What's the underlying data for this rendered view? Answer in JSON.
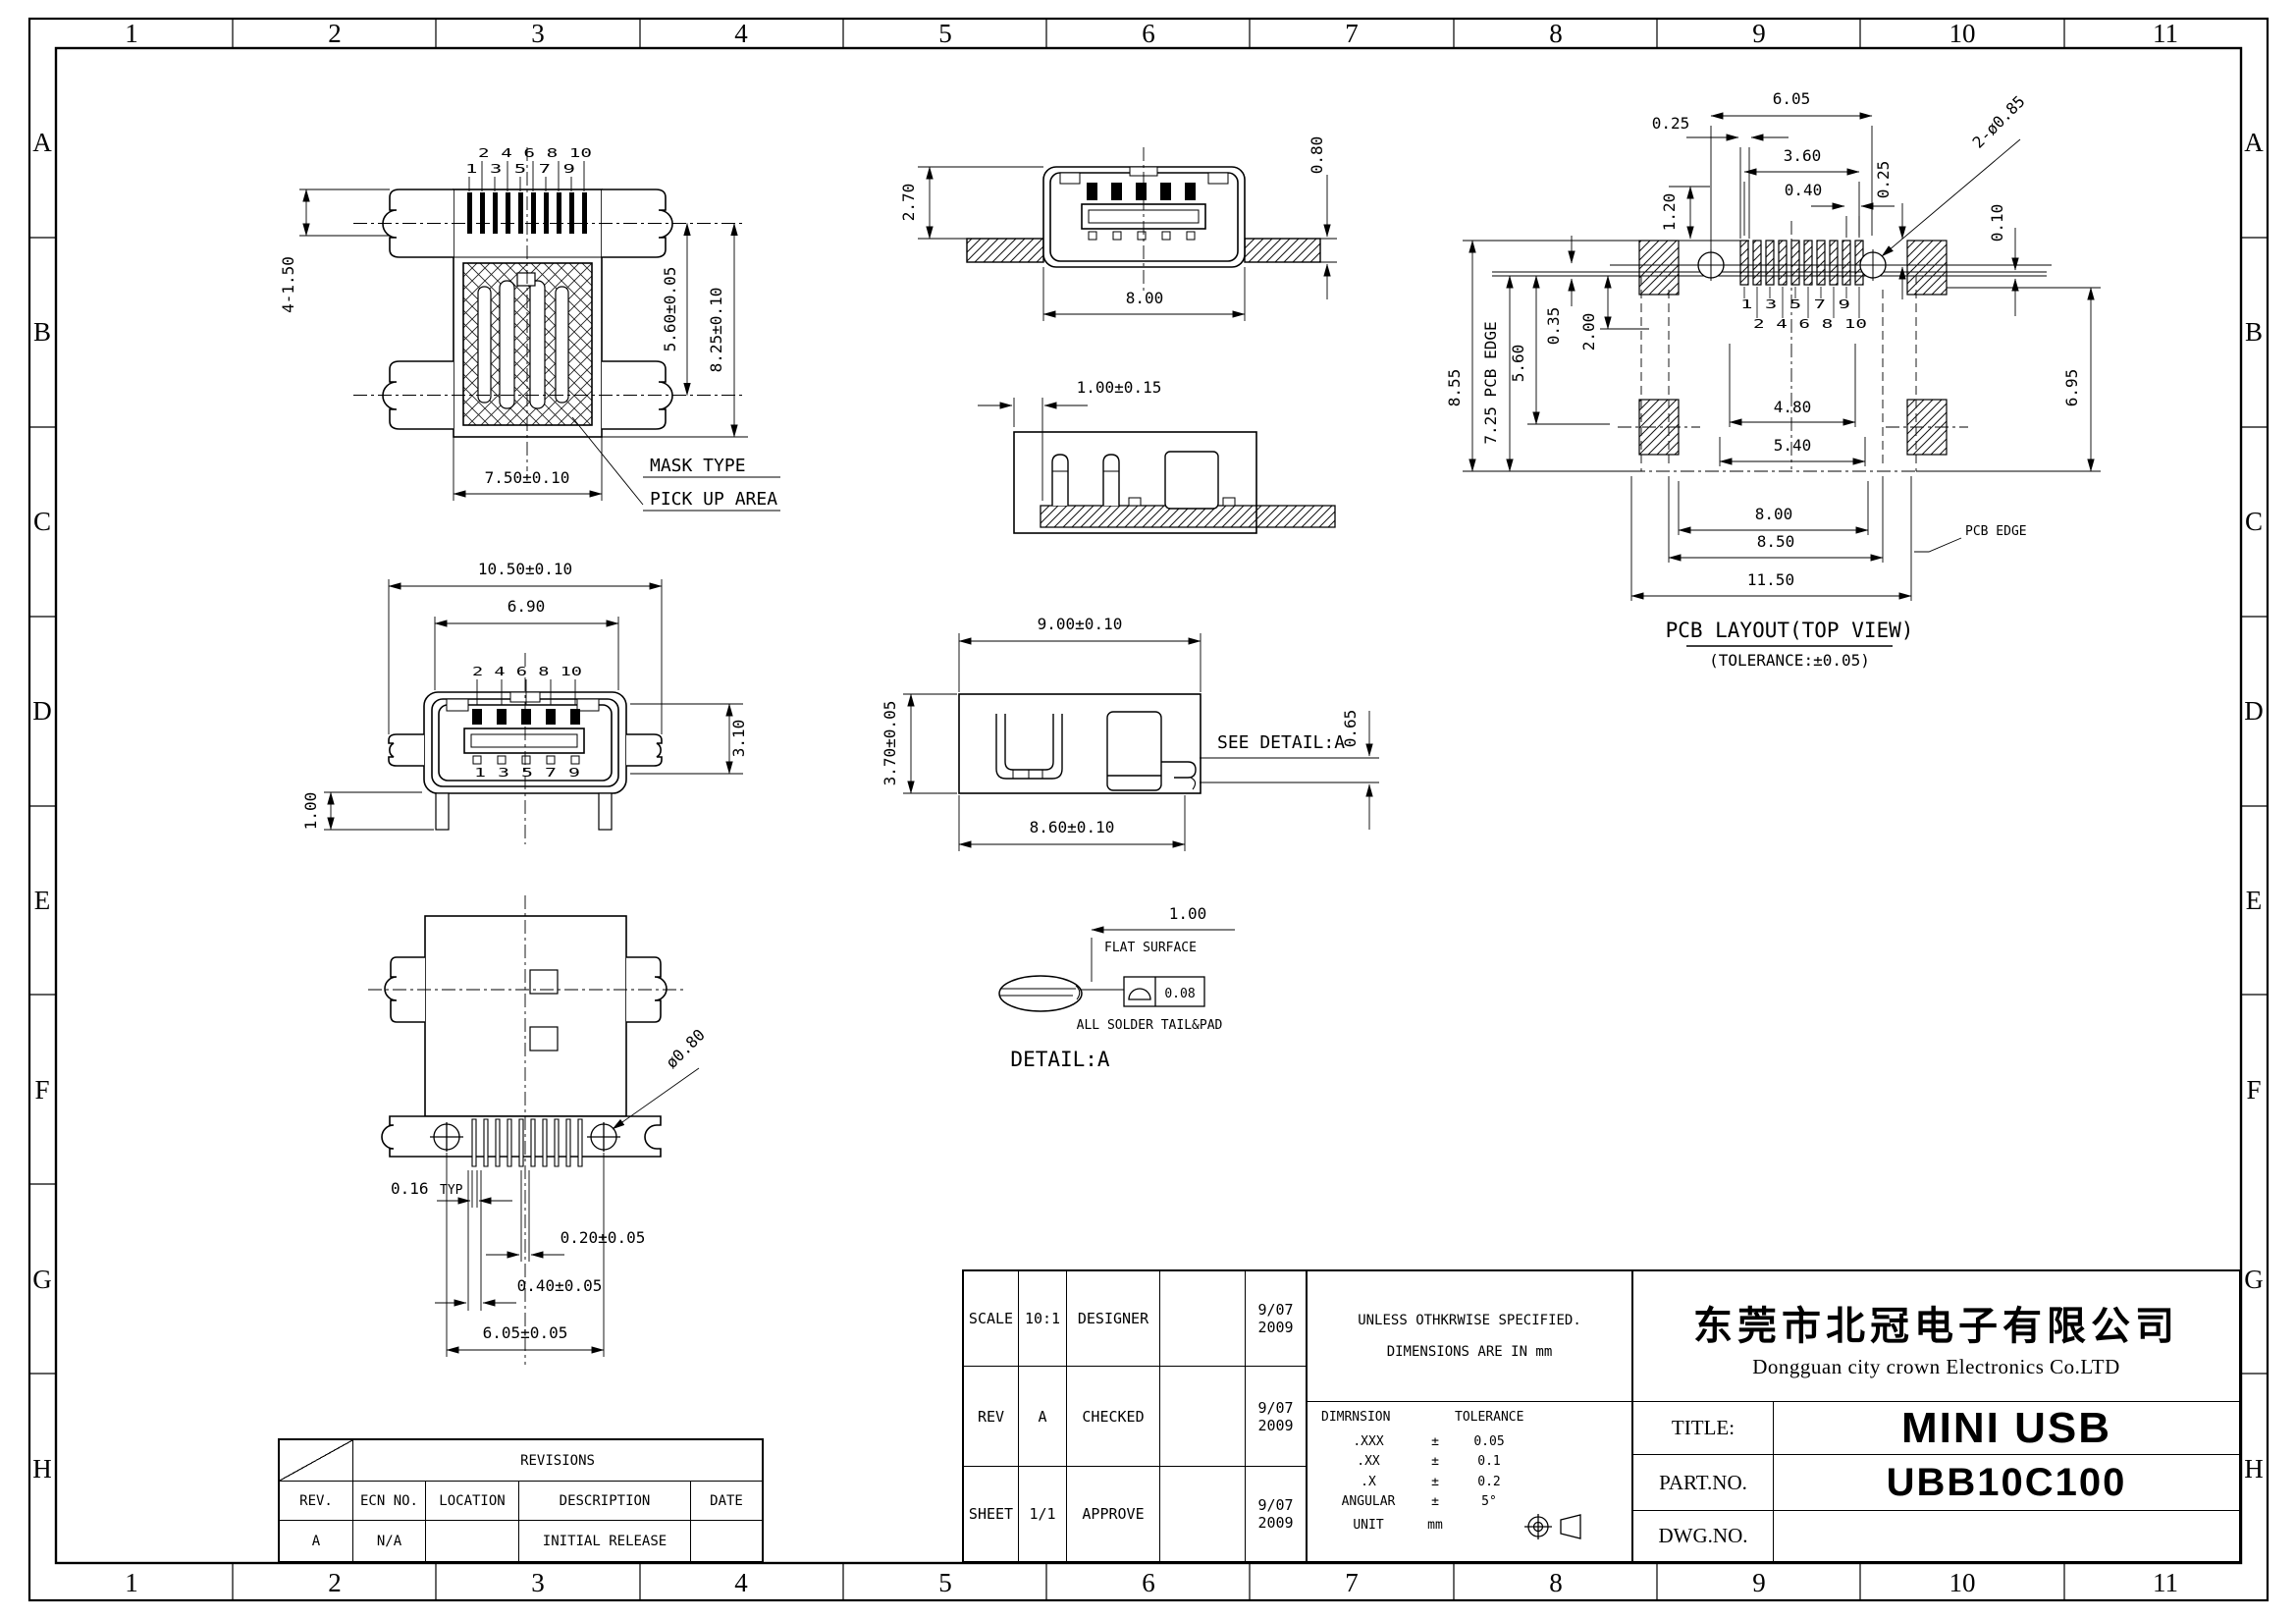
{
  "sheet": {
    "zone_cols": [
      "1",
      "2",
      "3",
      "4",
      "5",
      "6",
      "7",
      "8",
      "9",
      "10",
      "11"
    ],
    "zone_rows": [
      "A",
      "B",
      "C",
      "D",
      "E",
      "F",
      "G",
      "H"
    ]
  },
  "views": {
    "mask_top": {
      "pins_even": "2 4 6 8 10",
      "pins_odd": "1 3 5 7 9",
      "dim_tab": "4-1.50",
      "dim_inner": "5.60±0.05",
      "dim_outer": "8.25±0.10",
      "dim_width": "7.50±0.10",
      "label_mask": "MASK TYPE",
      "label_pickup": "PICK UP AREA"
    },
    "front": {
      "dim_total": "10.50±0.10",
      "dim_shell": "6.90",
      "pins_top": "2 4 6 8 10",
      "pins_bottom": "1 3 5 7 9",
      "dim_height": "3.10",
      "dim_standoff": "1.00"
    },
    "bottom": {
      "dim_pin": "0.16",
      "dim_pin_suffix": "TYP",
      "dim_gap": "0.20±0.05",
      "dim_pitch": "0.40±0.05",
      "dim_span": "6.05±0.05",
      "dim_hole": "ø0.80"
    },
    "front_pcb": {
      "dim_height": "2.70",
      "dim_pcb": "0.80",
      "dim_width": "8.00"
    },
    "section": {
      "dim": "1.00±0.15"
    },
    "side": {
      "dim_top": "9.00±0.10",
      "dim_left": "3.70±0.05",
      "dim_bottom": "8.60±0.10",
      "see_detail": "SEE DETAIL:A",
      "dim_tail": "0.65"
    },
    "detail_a": {
      "dim": "1.00",
      "flat": "FLAT SURFACE",
      "flatness": "0.08",
      "solder": "ALL SOLDER TAIL&PAD",
      "title": "DETAIL:A"
    },
    "pcb_layout": {
      "dim_605": "6.05",
      "dim_025l": "0.25",
      "dim_360": "3.60",
      "dim_040": "0.40",
      "dim_120": "1.20",
      "dim_025r": "0.25",
      "dim_holes": "2-ø0.85",
      "dim_010": "0.10",
      "dim_855": "8.55",
      "dim_725": "7.25 PCB EDGE",
      "dim_560": "5.60",
      "dim_035": "0.35",
      "dim_200": "2.00",
      "pins_odd": "1 3 5 7 9",
      "pins_even": "2 4 6 8 10",
      "dim_480": "4.80",
      "dim_540": "5.40",
      "dim_695": "6.95",
      "dim_800": "8.00",
      "dim_850": "8.50",
      "dim_1150": "11.50",
      "label_edge": "PCB EDGE",
      "title": "PCB LAYOUT(TOP VIEW)",
      "subtitle": "(TOLERANCE:±0.05)"
    }
  },
  "title_block": {
    "scale_label": "SCALE",
    "scale_value": "10:1",
    "designer_label": "DESIGNER",
    "rev_label": "REV",
    "rev_value": "A",
    "checked_label": "CHECKED",
    "sheet_label": "SHEET",
    "sheet_value": "1/1",
    "approve_label": "APPROVE",
    "date_m": "9/07",
    "date_y": "2009",
    "notes_line1": "UNLESS OTHKRWISE SPECIFIED.",
    "notes_line2": "DIMENSIONS ARE IN mm",
    "tol": {
      "header_dim": "DIMRNSION",
      "header_tol": "TOLERANCE",
      "rows": [
        [
          ".XXX",
          "±",
          "0.05"
        ],
        [
          ".XX",
          "±",
          "0.1"
        ],
        [
          ".X",
          "±",
          "0.2"
        ],
        [
          "ANGULAR",
          "±",
          "5°"
        ]
      ],
      "unit_label": "UNIT",
      "unit_value": "mm"
    },
    "company_cn": "东莞市北冠电子有限公司",
    "company_en": "Dongguan city crown Electronics Co.LTD",
    "title_label": "TITLE:",
    "title_value": "MINI USB",
    "part_label": "PART.NO.",
    "part_value": "UBB10C100",
    "dwg_label": "DWG.NO.",
    "dwg_value": ""
  },
  "revisions": {
    "header": "REVISIONS",
    "columns": [
      "REV.",
      "ECN NO.",
      "LOCATION",
      "DESCRIPTION",
      "DATE"
    ],
    "rows": [
      [
        "A",
        "N/A",
        "",
        "INITIAL RELEASE",
        ""
      ]
    ]
  }
}
